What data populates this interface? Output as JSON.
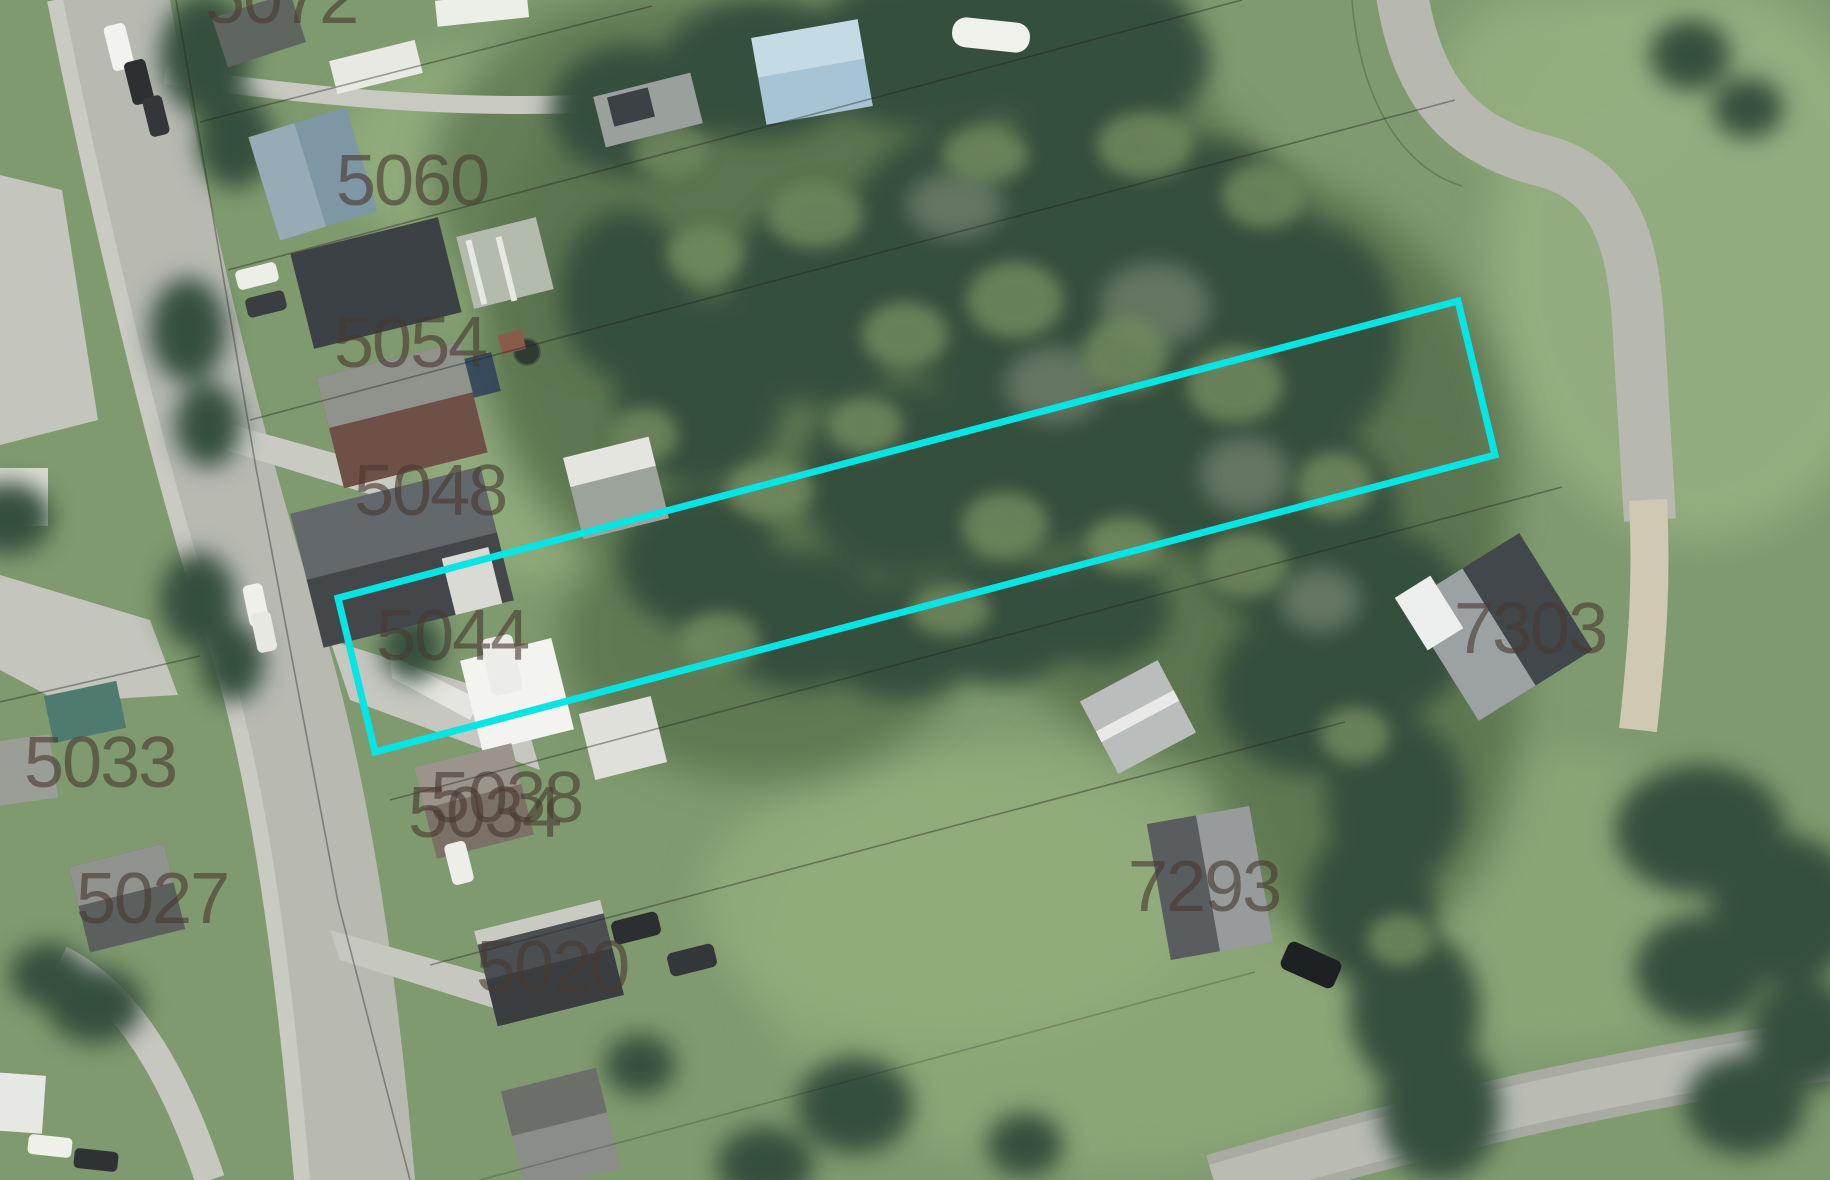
{
  "map": {
    "type": "aerial-parcel-imagery",
    "label_color": "rgba(72,57,48,0.62)",
    "parcel_labels": [
      {
        "text": "5072",
        "x": 205,
        "y": -37,
        "clipped_top": true
      },
      {
        "text": "5060",
        "x": 336,
        "y": 145
      },
      {
        "text": "5054",
        "x": 334,
        "y": 307
      },
      {
        "text": "5048",
        "x": 354,
        "y": 455
      },
      {
        "text": "5044",
        "x": 376,
        "y": 600
      },
      {
        "text": "5038",
        "x": 430,
        "y": 762
      },
      {
        "text": "5033",
        "x": 24,
        "y": 727
      },
      {
        "text": "5034",
        "x": 408,
        "y": 777
      },
      {
        "text": "5027",
        "x": 76,
        "y": 863
      },
      {
        "text": "5020",
        "x": 476,
        "y": 931
      },
      {
        "text": "7293",
        "x": 1128,
        "y": 851
      },
      {
        "text": "7303",
        "x": 1454,
        "y": 593
      }
    ],
    "highlight_parcel": {
      "color": "#06e4e4",
      "stroke_width": 7,
      "points": [
        [
          338,
          598
        ],
        [
          1458,
          301
        ],
        [
          1495,
          455
        ],
        [
          375,
          752
        ]
      ]
    }
  }
}
